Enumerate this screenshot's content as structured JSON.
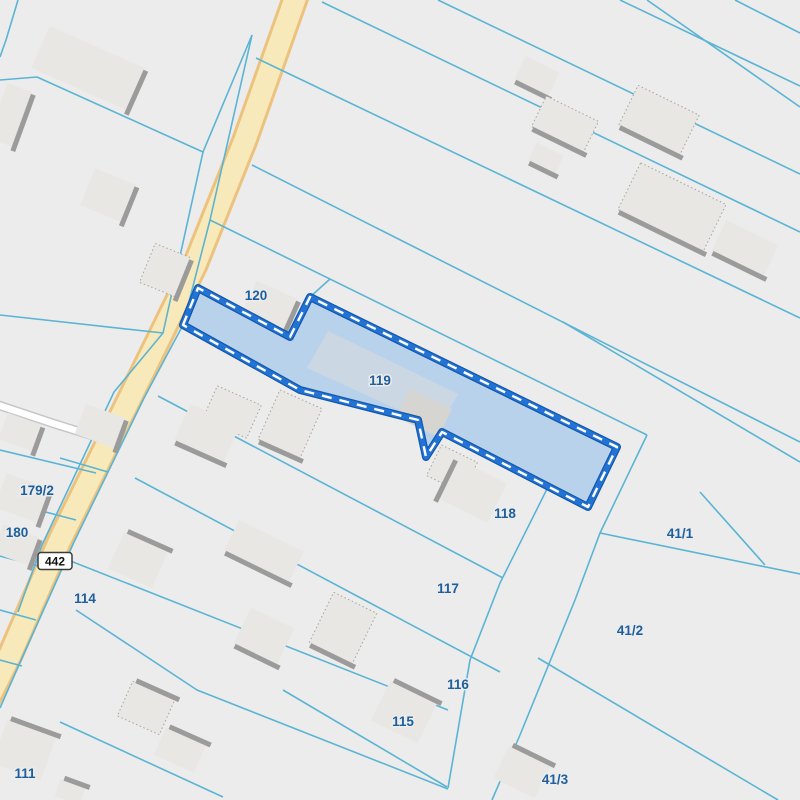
{
  "map": {
    "width": 800,
    "height": 800,
    "colors": {
      "background": "#ececec",
      "parcel_line": "#5ab4d4",
      "road_fill": "#f8e9bb",
      "road_casing": "#ecc37e",
      "minor_road_fill": "#ffffff",
      "minor_road_casing": "#c6c6c6",
      "selected_fill": "#b9d2ec",
      "selected_stroke_outer": "#1558aa",
      "selected_stroke": "#2173d6",
      "selected_dash": "#ffffff",
      "building_fill": "#e9e7e4",
      "building_shadow": "#9b9b9b",
      "building_dot": "#a5a3a0",
      "selected_building_fill": "#ccd7e4",
      "selected_building_fill_alt": "#d7d5d2",
      "label_color": "#1d5f9c",
      "label_halo": "#ececec",
      "shield_bg": "#ffffff",
      "shield_border": "#3c3c3c",
      "shield_text_color": "#111111"
    },
    "roads": {
      "main_road": {
        "points": [
          [
            300,
            -15
          ],
          [
            245,
            140
          ],
          [
            195,
            265
          ],
          [
            129,
            400
          ],
          [
            60,
            540
          ],
          [
            10,
            655
          ],
          [
            -30,
            735
          ]
        ]
      },
      "minor_road": {
        "points": [
          [
            -5,
            404
          ],
          [
            55,
            424
          ],
          [
            100,
            438
          ]
        ]
      }
    },
    "road_shield": {
      "text": "442",
      "x": 55,
      "y": 561
    },
    "boundary_lines": [
      {
        "pts": [
          [
            18,
            0
          ],
          [
            6,
            40
          ],
          [
            0,
            57
          ]
        ]
      },
      {
        "pts": [
          [
            0,
            80
          ],
          [
            37,
            77
          ],
          [
            203,
            152
          ],
          [
            252,
            35
          ]
        ]
      },
      {
        "pts": [
          [
            252,
            35
          ],
          [
            210,
            220
          ],
          [
            183,
            325
          ],
          [
            144,
            398
          ],
          [
            74,
            542
          ],
          [
            22,
            658
          ],
          [
            0,
            708
          ]
        ]
      },
      {
        "pts": [
          [
            203,
            152
          ],
          [
            163,
            333
          ],
          [
            114,
            392
          ],
          [
            42,
            545
          ],
          [
            18,
            612
          ]
        ]
      },
      {
        "pts": [
          [
            0,
            315
          ],
          [
            163,
            333
          ]
        ]
      },
      {
        "pts": [
          [
            322,
            2
          ],
          [
            800,
            232
          ]
        ]
      },
      {
        "pts": [
          [
            438,
            0
          ],
          [
            800,
            174
          ]
        ]
      },
      {
        "pts": [
          [
            620,
            0
          ],
          [
            800,
            86
          ]
        ]
      },
      {
        "pts": [
          [
            647,
            0
          ],
          [
            800,
            107
          ]
        ]
      },
      {
        "pts": [
          [
            735,
            0
          ],
          [
            800,
            33
          ]
        ]
      },
      {
        "pts": [
          [
            256,
            58
          ],
          [
            800,
            318
          ]
        ]
      },
      {
        "pts": [
          [
            252,
            165
          ],
          [
            800,
            442
          ]
        ]
      },
      {
        "pts": [
          [
            210,
            220
          ],
          [
            647,
            435
          ]
        ]
      },
      {
        "pts": [
          [
            310,
            297
          ],
          [
            330,
            279
          ]
        ]
      },
      {
        "pts": [
          [
            563,
            322
          ],
          [
            800,
            462
          ]
        ]
      },
      {
        "pts": [
          [
            158,
            396
          ],
          [
            503,
            578
          ]
        ]
      },
      {
        "pts": [
          [
            135,
            478
          ],
          [
            500,
            672
          ]
        ]
      },
      {
        "pts": [
          [
            68,
            560
          ],
          [
            448,
            710
          ]
        ]
      },
      {
        "pts": [
          [
            76,
            610
          ],
          [
            197,
            690
          ],
          [
            448,
            789
          ]
        ]
      },
      {
        "pts": [
          [
            283,
            690
          ],
          [
            447,
            787
          ]
        ]
      },
      {
        "pts": [
          [
            60,
            722
          ],
          [
            223,
            797
          ]
        ]
      },
      {
        "pts": [
          [
            548,
            487
          ],
          [
            500,
            583
          ],
          [
            470,
            660
          ],
          [
            448,
            788
          ]
        ]
      },
      {
        "pts": [
          [
            647,
            435
          ],
          [
            600,
            533
          ],
          [
            575,
            600
          ],
          [
            520,
            735
          ],
          [
            492,
            800
          ]
        ]
      },
      {
        "pts": [
          [
            600,
            533
          ],
          [
            800,
            574
          ]
        ]
      },
      {
        "pts": [
          [
            700,
            492
          ],
          [
            765,
            565
          ]
        ]
      },
      {
        "pts": [
          [
            538,
            658
          ],
          [
            778,
            800
          ]
        ]
      },
      {
        "pts": [
          [
            0,
            450
          ],
          [
            96,
            473
          ]
        ]
      },
      {
        "pts": [
          [
            0,
            500
          ],
          [
            76,
            520
          ]
        ]
      },
      {
        "pts": [
          [
            0,
            556
          ],
          [
            50,
            569
          ]
        ]
      },
      {
        "pts": [
          [
            0,
            610
          ],
          [
            36,
            620
          ]
        ]
      },
      {
        "pts": [
          [
            0,
            660
          ],
          [
            22,
            666
          ]
        ]
      },
      {
        "pts": [
          [
            60,
            458
          ],
          [
            108,
            472
          ]
        ]
      }
    ],
    "selected_parcel": {
      "label": "119",
      "points": [
        [
          183,
          325
        ],
        [
          198,
          288
        ],
        [
          290,
          337
        ],
        [
          310,
          297
        ],
        [
          617,
          447
        ],
        [
          588,
          507
        ],
        [
          442,
          432
        ],
        [
          426,
          457
        ],
        [
          418,
          420
        ],
        [
          300,
          390
        ]
      ]
    },
    "selected_buildings": [
      {
        "points": [
          [
            328,
            331
          ],
          [
            458,
            394
          ],
          [
            449,
            410
          ],
          [
            421,
            396
          ],
          [
            410,
            415
          ],
          [
            307,
            368
          ]
        ],
        "fill": "selected_building_fill"
      },
      {
        "points": [
          [
            410,
            389
          ],
          [
            452,
            409
          ],
          [
            438,
            437
          ],
          [
            396,
            417
          ]
        ],
        "fill": "selected_building_fill_alt"
      }
    ],
    "buildings": [
      {
        "cx": 88,
        "cy": 68,
        "w": 104,
        "h": 46,
        "rot": 24,
        "shadow": "E",
        "dotted": false
      },
      {
        "cx": 10,
        "cy": 115,
        "w": 26,
        "h": 58,
        "rot": 20,
        "shadow": "E",
        "dotted": false
      },
      {
        "cx": 108,
        "cy": 195,
        "w": 44,
        "h": 40,
        "rot": 22,
        "shadow": "E",
        "dotted": false
      },
      {
        "cx": 165,
        "cy": 270,
        "w": 38,
        "h": 42,
        "rot": 22,
        "shadow": "E",
        "dotted": true
      },
      {
        "cx": 537,
        "cy": 76,
        "w": 38,
        "h": 26,
        "rot": 26,
        "shadow": "S",
        "dotted": false
      },
      {
        "cx": 565,
        "cy": 124,
        "w": 58,
        "h": 34,
        "rot": 26,
        "shadow": "S",
        "dotted": true
      },
      {
        "cx": 659,
        "cy": 120,
        "w": 68,
        "h": 44,
        "rot": 26,
        "shadow": "S",
        "dotted": true
      },
      {
        "cx": 672,
        "cy": 207,
        "w": 95,
        "h": 52,
        "rot": 26,
        "shadow": "S",
        "dotted": true
      },
      {
        "cx": 745,
        "cy": 248,
        "w": 58,
        "h": 34,
        "rot": 26,
        "shadow": "S",
        "dotted": false
      },
      {
        "cx": 546,
        "cy": 158,
        "w": 30,
        "h": 20,
        "rot": 26,
        "shadow": "S",
        "dotted": false
      },
      {
        "cx": 268,
        "cy": 310,
        "w": 45,
        "h": 44,
        "rot": 24,
        "shadow": "E",
        "dotted": false
      },
      {
        "cx": 232,
        "cy": 412,
        "w": 48,
        "h": 36,
        "rot": 24,
        "shadow": null,
        "dotted": true
      },
      {
        "cx": 207,
        "cy": 433,
        "w": 54,
        "h": 40,
        "rot": 24,
        "shadow": "S",
        "dotted": false
      },
      {
        "cx": 290,
        "cy": 424,
        "w": 46,
        "h": 54,
        "rot": 24,
        "shadow": "S",
        "dotted": true
      },
      {
        "cx": 452,
        "cy": 469,
        "w": 40,
        "h": 34,
        "rot": 26,
        "shadow": null,
        "dotted": true
      },
      {
        "cx": 473,
        "cy": 491,
        "w": 54,
        "h": 44,
        "rot": 26,
        "shadow": "W",
        "dotted": false
      },
      {
        "cx": 20,
        "cy": 432,
        "w": 36,
        "h": 28,
        "rot": 20,
        "shadow": "E",
        "dotted": false
      },
      {
        "cx": 100,
        "cy": 426,
        "w": 42,
        "h": 32,
        "rot": 20,
        "shadow": "E",
        "dotted": false
      },
      {
        "cx": 22,
        "cy": 498,
        "w": 46,
        "h": 36,
        "rot": 20,
        "shadow": "E",
        "dotted": false
      },
      {
        "cx": 16,
        "cy": 545,
        "w": 38,
        "h": 30,
        "rot": 20,
        "shadow": "E",
        "dotted": false
      },
      {
        "cx": 138,
        "cy": 560,
        "w": 48,
        "h": 40,
        "rot": 24,
        "shadow": "N",
        "dotted": false
      },
      {
        "cx": 264,
        "cy": 551,
        "w": 72,
        "h": 34,
        "rot": 26,
        "shadow": "S",
        "dotted": false
      },
      {
        "cx": 343,
        "cy": 628,
        "w": 48,
        "h": 56,
        "rot": 26,
        "shadow": "S",
        "dotted": true
      },
      {
        "cx": 264,
        "cy": 636,
        "w": 48,
        "h": 40,
        "rot": 26,
        "shadow": "S",
        "dotted": false
      },
      {
        "cx": 146,
        "cy": 708,
        "w": 46,
        "h": 38,
        "rot": 24,
        "shadow": "N",
        "dotted": true
      },
      {
        "cx": 180,
        "cy": 750,
        "w": 44,
        "h": 30,
        "rot": 24,
        "shadow": "N",
        "dotted": false
      },
      {
        "cx": 24,
        "cy": 750,
        "w": 52,
        "h": 46,
        "rot": 20,
        "shadow": "N",
        "dotted": false
      },
      {
        "cx": 70,
        "cy": 792,
        "w": 26,
        "h": 18,
        "rot": 20,
        "shadow": "N",
        "dotted": false
      },
      {
        "cx": 404,
        "cy": 712,
        "w": 52,
        "h": 44,
        "rot": 26,
        "shadow": "N",
        "dotted": false
      },
      {
        "cx": 522,
        "cy": 772,
        "w": 46,
        "h": 36,
        "rot": 26,
        "shadow": "N",
        "dotted": false
      }
    ],
    "parcel_labels": [
      {
        "text": "120",
        "x": 256,
        "y": 300
      },
      {
        "text": "119",
        "x": 380,
        "y": 385
      },
      {
        "text": "118",
        "x": 505,
        "y": 518
      },
      {
        "text": "117",
        "x": 448,
        "y": 593
      },
      {
        "text": "116",
        "x": 458,
        "y": 689
      },
      {
        "text": "115",
        "x": 403,
        "y": 726
      },
      {
        "text": "114",
        "x": 85,
        "y": 603
      },
      {
        "text": "111",
        "x": 25,
        "y": 778
      },
      {
        "text": "179/2",
        "x": 37,
        "y": 495
      },
      {
        "text": "180",
        "x": 17,
        "y": 537
      },
      {
        "text": "41/1",
        "x": 680,
        "y": 538
      },
      {
        "text": "41/2",
        "x": 630,
        "y": 635
      },
      {
        "text": "41/3",
        "x": 555,
        "y": 784
      }
    ]
  }
}
